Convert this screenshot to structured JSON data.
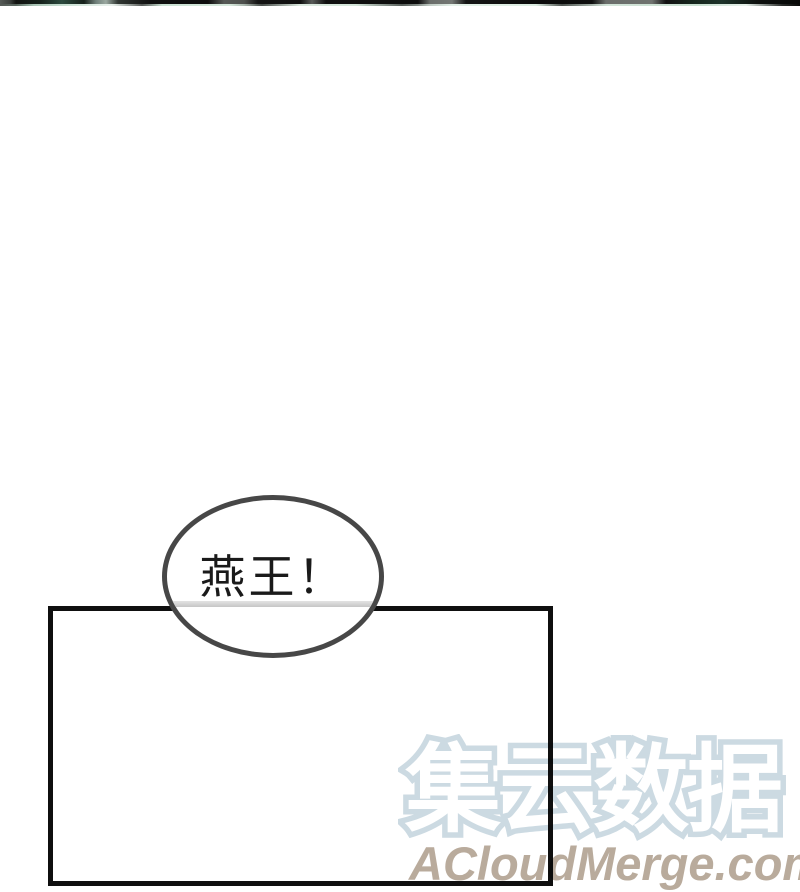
{
  "page": {
    "kind": "manhua-webtoon-page",
    "background_color": "#ffffff"
  },
  "previous_panel_edge": {
    "description": "dark bottom sliver of previous comic panel",
    "dark_color": "#101311",
    "teal_color": "#2c4a3e",
    "highlight_color": "#dcece2"
  },
  "panel": {
    "border_color": "#0f0f0f",
    "fill_color": "#ffffff"
  },
  "speech_bubble": {
    "text": "燕王！",
    "text_color": "#1a1a1a",
    "outline_color": "#474747",
    "fill_color": "#ffffff",
    "occluded_border_color": "#c6c6c6"
  },
  "watermark": {
    "cn_text": "集云数据",
    "cn_outline_color": "#ccdae2",
    "en_text": "ACloudMerge.com",
    "en_color": "#b9ab9c"
  }
}
